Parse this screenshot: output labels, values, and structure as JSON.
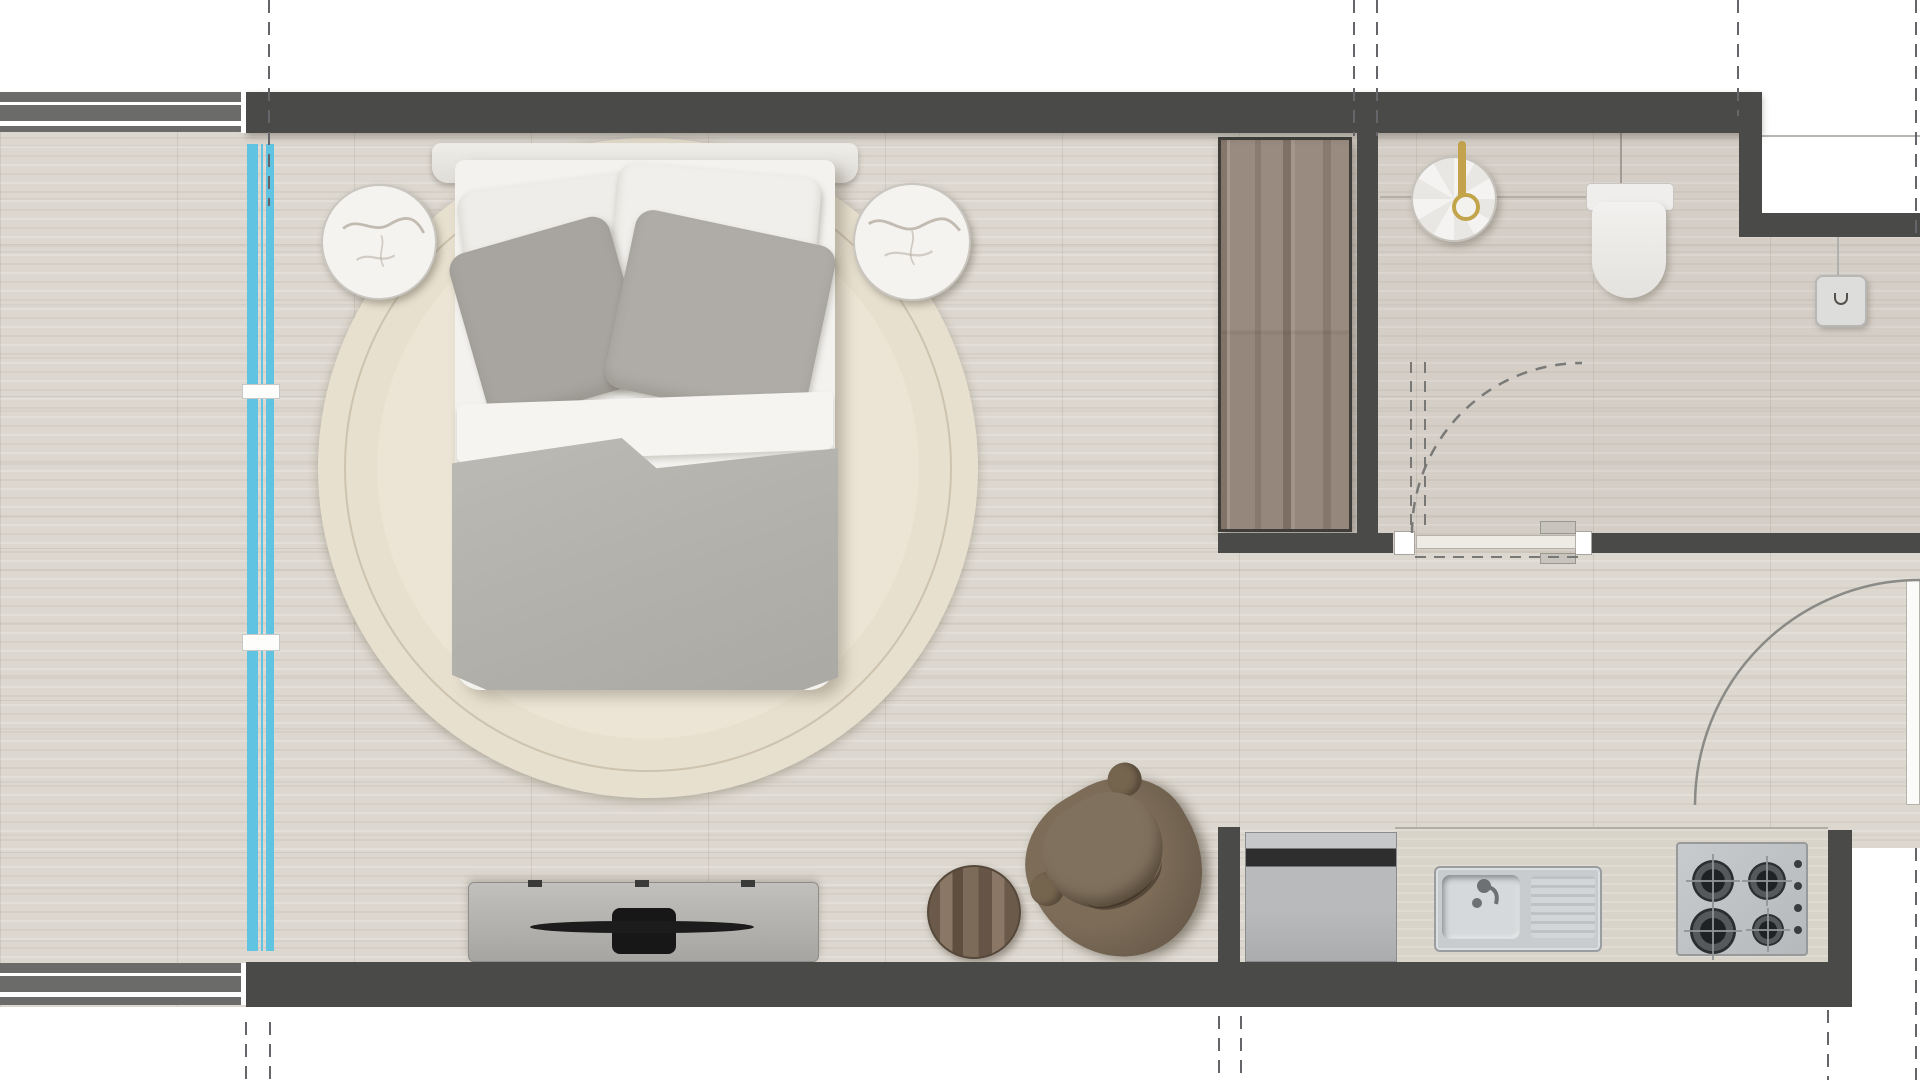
{
  "plan": {
    "kind": "studio-apartment-floor-plan",
    "visible_text": ""
  },
  "colors": {
    "wall": "#4a4a48",
    "neighbor_wall": "#6b6b69",
    "floor": "#dcd7cf",
    "window_glass": "#5fc3e1",
    "rug": "#e8e0cf",
    "marble": "#f5f3f0",
    "linen_white": "#f3f2ef",
    "pillow_gray": "#a8a5a0",
    "duvet": "#b4b2ad",
    "wardrobe_wood": "#95877b",
    "chair_brown": "#6e5f4e",
    "stool_wood": "#7c6a58",
    "steel": "#c9ccce",
    "tv_black": "#1c1c1c",
    "gold": "#c3a24b",
    "fixture_white": "#f1f0ee"
  },
  "elements": {
    "floor": "tiled travertine floor",
    "bathroom_floor": "bathroom floor area",
    "top_wall": "exterior wall (top)",
    "bottom_wall": "exterior wall (bottom)",
    "neighbor_wall_top": "adjacent unit wall (top left)",
    "neighbor_wall_bottom": "adjacent unit wall (bottom left)",
    "bathroom_wall": "bathroom partition wall",
    "kitchen_wall": "kitchen partition wall",
    "window": "full-height glazing (blue)",
    "rug": "round cream rug",
    "bed": "double bed",
    "headboard": "bed headboard",
    "pillow_white_left": "white pillow (left)",
    "pillow_white_right": "white pillow (right)",
    "pillow_gray_left": "gray pillow (left)",
    "pillow_gray_right": "gray pillow (right)",
    "sheet_fold": "folded white sheet",
    "duvet": "gray duvet",
    "nightstand_left": "round marble side table (left)",
    "nightstand_right": "round marble side table (right)",
    "wardrobe": "timber wardrobe",
    "tv_console": "media console",
    "tv": "television",
    "lounge_chair": "brown lounge chair",
    "side_stool": "round timber stool",
    "fridge": "under-counter fridge appliance",
    "kitchen_counter": "kitchen counter",
    "kitchen_sink": "stainless sink with drainer",
    "gas_hob": "4-burner gas hob",
    "basin": "round basin with brass tap",
    "toilet": "wall-faced toilet",
    "light_switch": "switch / intercom plate",
    "bathroom_door": "bathroom swing door",
    "entry_door": "entry swing door",
    "gridline": "dashed setting-out gridline",
    "balcony_ledge": "balcony edge line"
  }
}
